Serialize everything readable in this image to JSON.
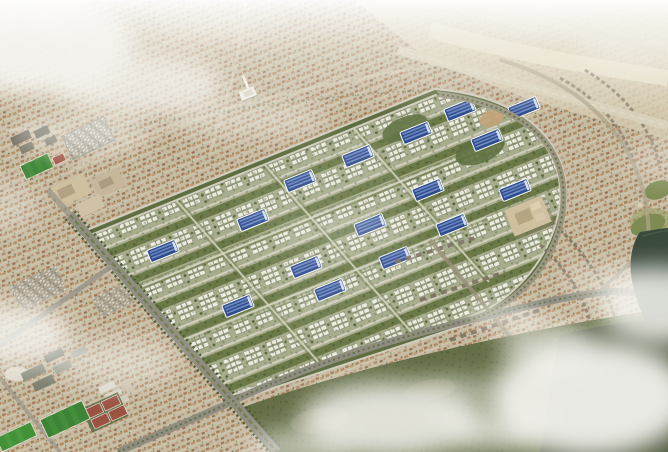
{
  "meta": {
    "type": "architectural-aerial-render",
    "subject": "Master-planned villa community aerial rendering",
    "grid_orientation_deg": -22
  },
  "scene": {
    "description": "Aerial 3D rendering of a large master-planned residential community: a diamond-shaped development parcel filled with white villas, landscaped green avenues and blue-roofed buildings, bounded by tree-lined boulevards; surrounded by dense beige desert suburbs with terracotta rooftops, a mosque with minaret, school campuses with bright football pitches and red courts, sandy desert with a highway to the north-east, arcs of townhouses under construction to the east, a dark lake and olive parkland on the right, and soft white clouds drifting over the corners.",
    "regions": [
      {
        "name": "new-development-parcel",
        "desc": "rotated diamond parcel of white villa clusters, green avenue strips and blue-roofed buildings"
      },
      {
        "name": "existing-suburbs",
        "desc": "dense beige neighborhoods with muted terracotta rooftops and faint curving arterials"
      },
      {
        "name": "desert-north-east",
        "desc": "pale sandy desert crossed by a diagonal highway"
      },
      {
        "name": "school-campus-west",
        "desc": "dark campus blocks, football pitch, red court and car park"
      },
      {
        "name": "campus-south-west",
        "desc": "institutional slabs, four red tennis courts and two green pitches"
      },
      {
        "name": "construction-rows-east",
        "desc": "concentric arcs and columns of grey townhouses under construction"
      },
      {
        "name": "lake-and-park-east",
        "desc": "dark lake inlet, golf greens and olive parkland"
      },
      {
        "name": "clouds",
        "desc": "white cloud banks over top-left, bottom-right, left edge and bottom centre"
      }
    ],
    "landmarks": {
      "mosque_minaret": [
        245,
        95
      ],
      "major_intersection": [
        222,
        404
      ],
      "large_sand_building_east": [
        530,
        218
      ]
    },
    "blue_roof_buildings": {
      "count": 16,
      "positions": [
        [
          163,
          251
        ],
        [
          238,
          306
        ],
        [
          306,
          267
        ],
        [
          370,
          225
        ],
        [
          428,
          190
        ],
        [
          253,
          220
        ],
        [
          300,
          181
        ],
        [
          358,
          156
        ],
        [
          416,
          133
        ],
        [
          460,
          110
        ],
        [
          524,
          108
        ],
        [
          487,
          140
        ],
        [
          395,
          258
        ],
        [
          452,
          225
        ],
        [
          515,
          190
        ],
        [
          330,
          290
        ]
      ]
    },
    "clouds": [
      {
        "x": 35,
        "y": 45,
        "rx": 100,
        "ry": 50,
        "opacity": 0.95,
        "blur": 12
      },
      {
        "x": 140,
        "y": 85,
        "rx": 85,
        "ry": 32,
        "opacity": 0.75,
        "blur": 12
      },
      {
        "x": 250,
        "y": 118,
        "rx": 80,
        "ry": 20,
        "opacity": 0.45,
        "blur": 12
      },
      {
        "x": 80,
        "y": 132,
        "rx": 70,
        "ry": 22,
        "opacity": 0.5,
        "blur": 12
      },
      {
        "x": 210,
        "y": 22,
        "rx": 70,
        "ry": 18,
        "opacity": 0.35,
        "blur": 12
      },
      {
        "x": 12,
        "y": 335,
        "rx": 60,
        "ry": 32,
        "opacity": 0.8,
        "blur": 12
      },
      {
        "x": 115,
        "y": 362,
        "rx": 65,
        "ry": 24,
        "opacity": 0.5,
        "blur": 12
      },
      {
        "x": 0,
        "y": 205,
        "rx": 40,
        "ry": 26,
        "opacity": 0.35,
        "blur": 12
      },
      {
        "x": 390,
        "y": 420,
        "rx": 90,
        "ry": 38,
        "opacity": 0.85,
        "blur": 12
      },
      {
        "x": 300,
        "y": 447,
        "rx": 55,
        "ry": 18,
        "opacity": 0.6,
        "blur": 12
      },
      {
        "x": 495,
        "y": 430,
        "rx": 48,
        "ry": 20,
        "opacity": 0.7,
        "blur": 12
      },
      {
        "x": 545,
        "y": 345,
        "rx": 45,
        "ry": 25,
        "opacity": 0.6,
        "blur": 12
      },
      {
        "x": 460,
        "y": 392,
        "rx": 40,
        "ry": 16,
        "opacity": 0.45,
        "blur": 12
      },
      {
        "x": 590,
        "y": 398,
        "rx": 100,
        "ry": 58,
        "opacity": 0.92,
        "blur": 12
      },
      {
        "x": 660,
        "y": 305,
        "rx": 62,
        "ry": 38,
        "opacity": 0.85,
        "blur": 12
      },
      {
        "x": 505,
        "y": 317,
        "rx": 36,
        "ry": 13,
        "opacity": 0.5,
        "blur": 8
      },
      {
        "x": 602,
        "y": 282,
        "rx": 40,
        "ry": 16,
        "opacity": 0.45,
        "blur": 12
      },
      {
        "x": 640,
        "y": 45,
        "rx": 62,
        "ry": 26,
        "opacity": 0.45,
        "blur": 12
      },
      {
        "x": 545,
        "y": 16,
        "rx": 55,
        "ry": 16,
        "opacity": 0.4,
        "blur": 12
      },
      {
        "x": 666,
        "y": 160,
        "rx": 42,
        "ry": 22,
        "opacity": 0.3,
        "blur": 12
      },
      {
        "x": 340,
        "y": 230,
        "rx": 60,
        "ry": 16,
        "opacity": 0.18,
        "blur": 12
      }
    ]
  },
  "palette": {
    "urban_beige": "#c6bca4",
    "terracotta": "#b0885f",
    "dev_base": "#9fa585",
    "dev_green": "#6c7a48",
    "villa_white": "#ecebdf",
    "pool_blue": "#2f4c8e",
    "pool_blue_light": "#7d98cd",
    "road_gray": "#8f8c80",
    "road_light": "#d8d1bb",
    "sand": "#d8ceb3",
    "sand_light": "#e7dfc9",
    "tree_green": "#4c5c34",
    "boundary_green": "#5f6e41",
    "pitch_green": "#3d8436",
    "court_red": "#9c5242",
    "lake": "#3a4a3c",
    "park_olive": "#656e47",
    "cloud_white": "#f7f6f2",
    "building_beige": "#cfc0a0"
  }
}
